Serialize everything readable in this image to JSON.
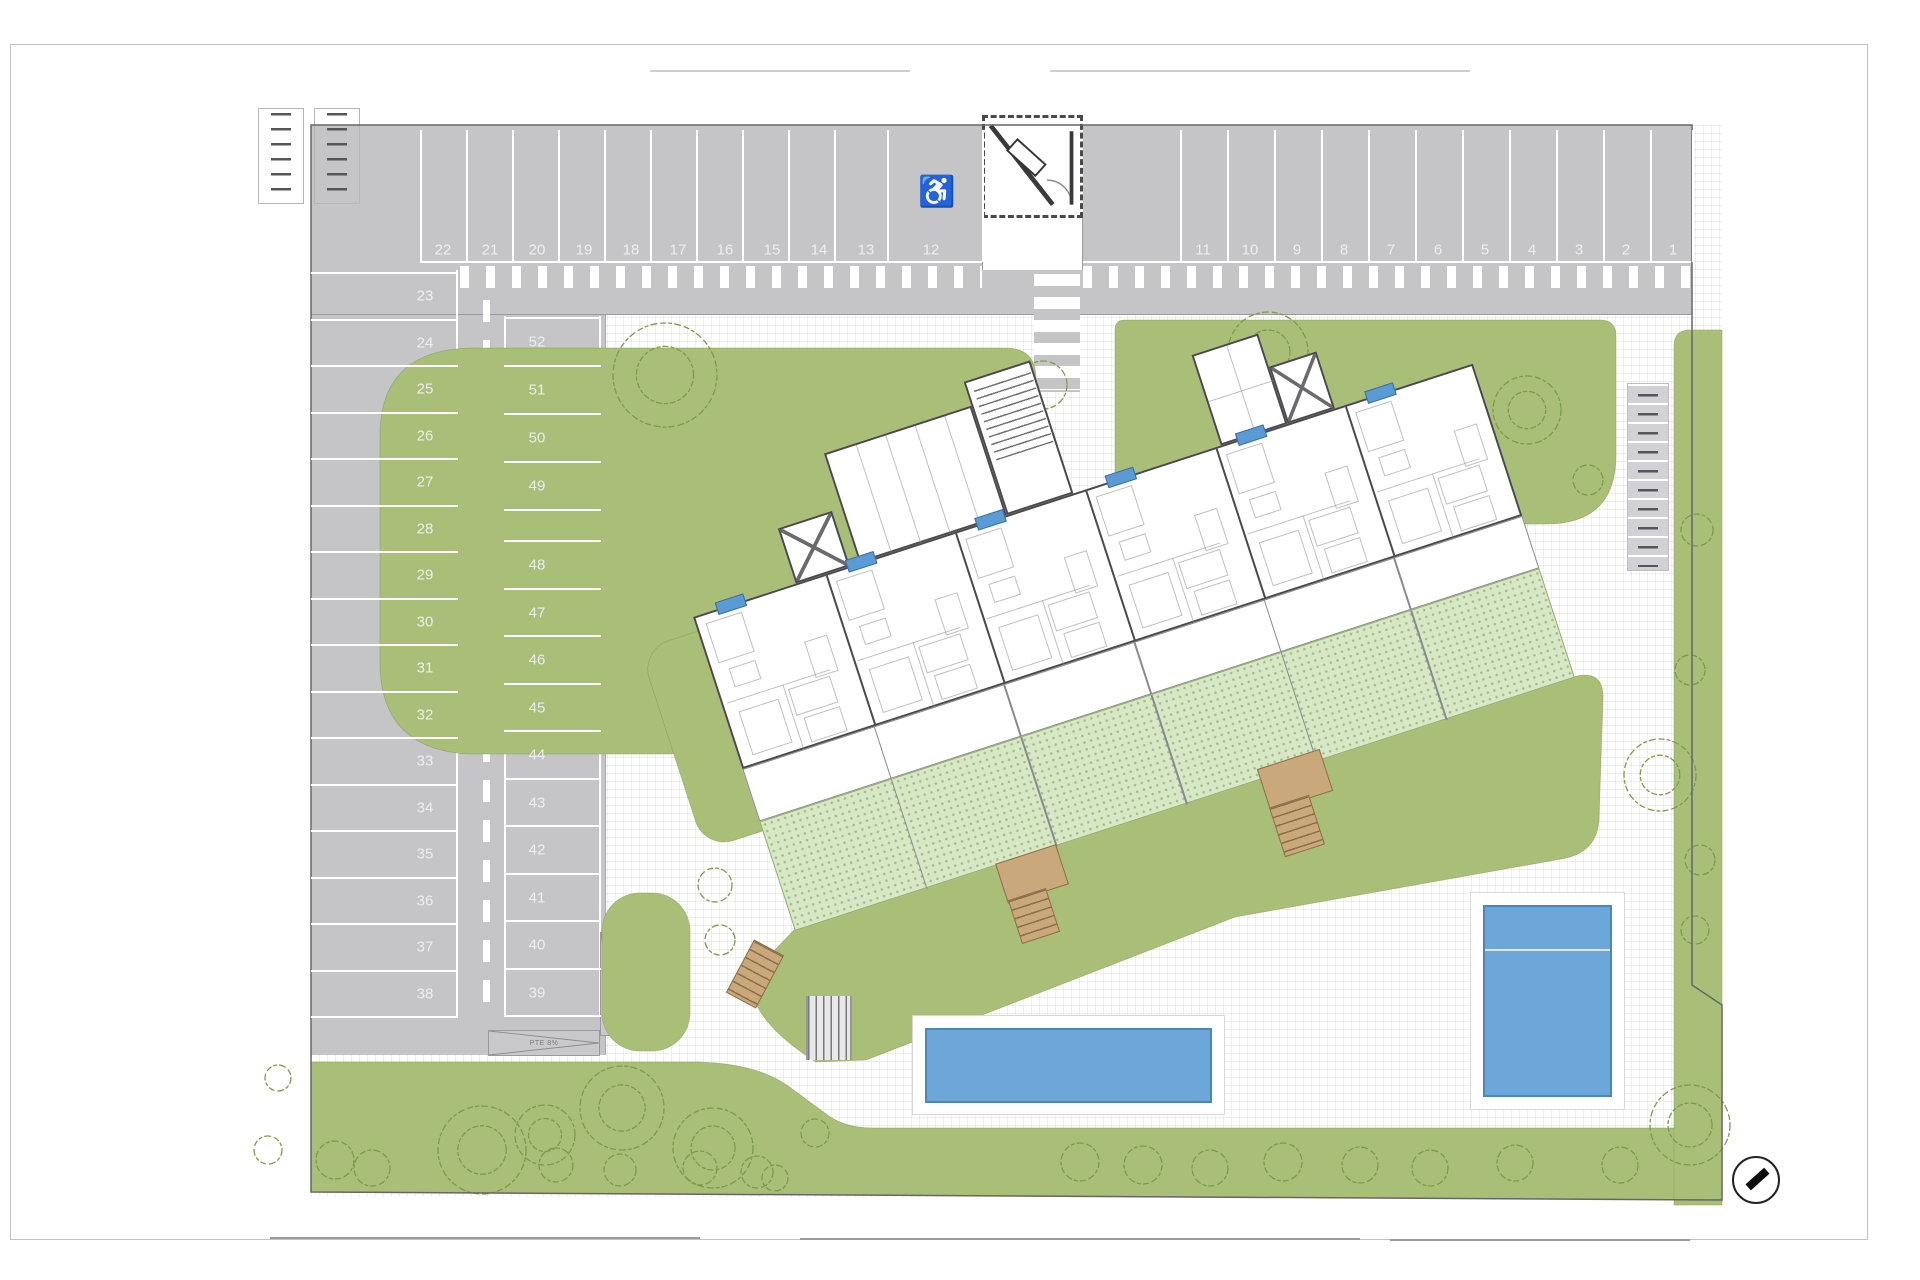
{
  "colors": {
    "asphalt": "#c5c5c8",
    "lawn": "#a9bf78",
    "tree_stroke": "#7c9c49",
    "garden": "#d8e7c6",
    "pool": "#6da6d9",
    "pool_border": "#4d87ba",
    "wall": "#4a4a4d",
    "chip_blue": "#5b9bd5",
    "wood": "#c9a97c"
  },
  "parking": {
    "top_row_left": {
      "numbers": [
        "22",
        "21",
        "20",
        "19",
        "18",
        "17",
        "16",
        "15",
        "14",
        "13",
        "12"
      ],
      "centers": [
        443,
        490,
        537,
        584,
        631,
        678,
        725,
        772,
        819,
        866,
        931
      ],
      "boundaries": [
        420,
        466,
        512,
        558,
        604,
        650,
        696,
        742,
        788,
        834,
        887,
        982
      ],
      "accessible_number": "12"
    },
    "top_row_right": {
      "numbers": [
        "11",
        "10",
        "9",
        "8",
        "7",
        "6",
        "5",
        "4",
        "3",
        "2",
        "1"
      ],
      "centers": [
        1203,
        1250,
        1297,
        1344,
        1391,
        1438,
        1485,
        1532,
        1579,
        1626,
        1673
      ],
      "boundaries": [
        1180,
        1227,
        1274,
        1321,
        1368,
        1415,
        1462,
        1509,
        1556,
        1603,
        1650,
        1692
      ]
    },
    "left_column": {
      "numbers": [
        "23",
        "24",
        "25",
        "26",
        "27",
        "28",
        "29",
        "30",
        "31",
        "32",
        "33",
        "34",
        "35",
        "36",
        "37",
        "38"
      ],
      "top": 272,
      "pitch": 46.5
    },
    "inner_column_upper": {
      "numbers": [
        "52",
        "51",
        "50",
        "49"
      ],
      "tops": [
        317,
        365,
        413,
        461
      ],
      "bottom": 509
    },
    "inner_column_lower": {
      "numbers": [
        "48",
        "47",
        "46",
        "45",
        "44",
        "43",
        "42",
        "41",
        "40",
        "39"
      ],
      "top": 540,
      "pitch": 47.5
    }
  },
  "ramps": {
    "top_a": "PTE 8%",
    "top_b": "PTE 8%",
    "bottom_h": "PTE 8%",
    "bottom_v": "PTE 6%"
  },
  "icons": {
    "accessible": "♿",
    "north_arrow": "compass-needle"
  },
  "building": {
    "unit_count": 6,
    "chip_count": 6
  },
  "landscape": {
    "trees_large": [
      [
        665,
        375,
        52
      ],
      [
        1268,
        352,
        40
      ],
      [
        1527,
        410,
        34
      ],
      [
        1660,
        775,
        36
      ],
      [
        482,
        1150,
        44
      ],
      [
        622,
        1108,
        42
      ],
      [
        713,
        1148,
        40
      ],
      [
        1690,
        1125,
        40
      ],
      [
        545,
        1135,
        30
      ]
    ],
    "trees_small": [
      [
        1043,
        385,
        24
      ],
      [
        335,
        1160,
        19
      ],
      [
        372,
        1168,
        18
      ],
      [
        556,
        1165,
        17
      ],
      [
        620,
        1170,
        16
      ],
      [
        700,
        1168,
        17
      ],
      [
        757,
        1172,
        16
      ],
      [
        815,
        1133,
        14
      ],
      [
        775,
        1178,
        13
      ],
      [
        1080,
        1162,
        19
      ],
      [
        1143,
        1165,
        19
      ],
      [
        1210,
        1168,
        18
      ],
      [
        1283,
        1162,
        19
      ],
      [
        1360,
        1165,
        18
      ],
      [
        1430,
        1168,
        18
      ],
      [
        1515,
        1163,
        18
      ],
      [
        1620,
        1165,
        18
      ],
      [
        1697,
        530,
        16
      ],
      [
        1690,
        670,
        15
      ],
      [
        1700,
        860,
        15
      ],
      [
        1695,
        930,
        14
      ],
      [
        1588,
        480,
        15
      ],
      [
        278,
        1078,
        13
      ],
      [
        268,
        1150,
        14
      ],
      [
        715,
        885,
        17
      ],
      [
        720,
        940,
        15
      ]
    ]
  }
}
